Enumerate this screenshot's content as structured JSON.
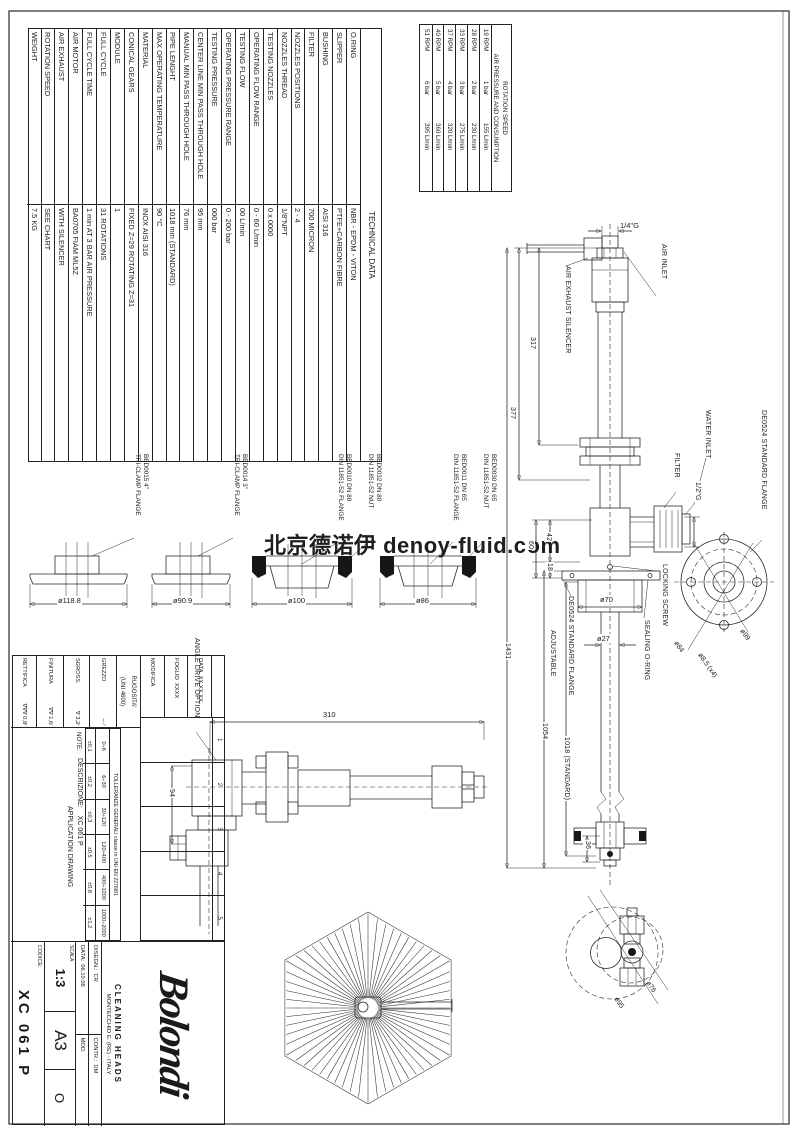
{
  "watermark": "北京德诺伊 denoy-fluid.com",
  "tech_table": {
    "header": "TECHNICAL DATA",
    "rows": [
      {
        "label": "O.RING",
        "value": "NBR - EPDM - VITON"
      },
      {
        "label": "SLIPPER",
        "value": "PTFE+CARBON FIBRE"
      },
      {
        "label": "BUSHING",
        "value": "AISI 316"
      },
      {
        "label": "FILTER",
        "value": "700 MICRON"
      },
      {
        "label": "NOZZLES POSITIONS",
        "value": "2 - 4"
      },
      {
        "label": "NOZZLES THREAD",
        "value": "1/8\"NPT"
      },
      {
        "label": "TESTING NOZZLES",
        "value": "0 x 0000"
      },
      {
        "label": "OPERATING FLOW RANGE",
        "value": "0 - 60 L/min"
      },
      {
        "label": "TESTING FLOW",
        "value": "00 L/min"
      },
      {
        "label": "OPERATING PRESSURE RANGE",
        "value": "0 - 200 bar"
      },
      {
        "label": "TESTING PRESSURE",
        "value": "000 bar"
      },
      {
        "label": "CENTER LINE MIN PASS THROUGH HOLE",
        "value": "95 mm"
      },
      {
        "label": "MANUAL MIN PASS THROUGH HOLE",
        "value": "76 mm"
      },
      {
        "label": "PIPE LENGHT",
        "value": "1018 mm (STANDARD)"
      },
      {
        "label": "MAX OPERATING TEMPERATURE",
        "value": "90 °C"
      },
      {
        "label": "MATERIAL",
        "value": "INOX AISI 316"
      },
      {
        "label": "CONICAL GEARS",
        "value": "FIXED Z=29 ROTATING Z=31"
      },
      {
        "label": "MODULE",
        "value": "1"
      },
      {
        "label": "FULL CYCLE",
        "value": "31 ROTATIONS"
      },
      {
        "label": "FULL CYCLE TIME",
        "value": "1 min AT 3 BAR AIR PRESSURE"
      },
      {
        "label": "AIR MOTOR",
        "value": "BA0705 FIAM ML5Z"
      },
      {
        "label": "AIR EXHAUST",
        "value": "WITH SILENCER"
      },
      {
        "label": "ROTATION SPEED",
        "value": "SEE CHART"
      },
      {
        "label": "WEIGHT",
        "value": "7.5 KG"
      }
    ]
  },
  "speed_table": {
    "title1": "ROTATION SPEED",
    "title2": "AIR PRESSURE AND CONSUMPTION",
    "rows": [
      {
        "rpm": "19 RPM",
        "bar": "1 bar",
        "flow": "155 L/min"
      },
      {
        "rpm": "28 RPM",
        "bar": "2 bar",
        "flow": "230 L/min"
      },
      {
        "rpm": "33 RPM",
        "bar": "3 bar",
        "flow": "275 L/min"
      },
      {
        "rpm": "37 RPM",
        "bar": "4 bar",
        "flow": "320 L/min"
      },
      {
        "rpm": "40 RPM",
        "bar": "5 bar",
        "flow": "360 L/min"
      },
      {
        "rpm": "51 RPM",
        "bar": "6 bar",
        "flow": "395 L/min"
      }
    ]
  },
  "labels": {
    "air_inlet": "AIR INLET",
    "air_inlet_size": "1/4\"G",
    "air_exhaust": "AIR EXHAUST SILENCER",
    "water_inlet": "WATER INLET",
    "water_inlet_size": "1/2\"G",
    "filter": "FILTER",
    "std_flange_right": "DE0524 STANDARD FLANGE",
    "std_flange_left": "DE0524 STANDARD FLANGE",
    "adjustable": "ADJUSTABLE",
    "locking_screw": "LOCKING SCREW",
    "sealing_oring": "SEALING O-RING",
    "angle_drive": "ANGLE DRIVE OPTION"
  },
  "dims": {
    "d317": "317",
    "d377": "377",
    "d42": "42",
    "d60": "60",
    "d18": "18",
    "d70": "ø70",
    "d27": "ø27",
    "d1431": "1431",
    "d1054": "1054",
    "d1018": "1018 (STANDARD)",
    "d36": "36",
    "d310": "310",
    "d94": "94",
    "d84": "ø84",
    "d85": "ø8.5 (x4)",
    "d99": "ø99",
    "d76": "ø76",
    "d95": "ø95"
  },
  "flange_dims": {
    "d1188": "ø118.8",
    "d909": "ø90.9",
    "d100": "ø100",
    "d86": "ø86"
  },
  "flanges": [
    {
      "code": "BED0015 4\"",
      "type": "TRI-CLAMP FLANGE"
    },
    {
      "code": "BED0014 3\"",
      "type": "TRI-CLAMP FLANGE"
    },
    {
      "code": "BED0010 DN 80",
      "type": "DIN 11851-52 FLANGE"
    },
    {
      "code": "BED0032 DN 80",
      "type": "DIN 11851-52 NUT"
    },
    {
      "code": "BED0011 DN 65",
      "type": "DIN 11851-52 FLANGE"
    },
    {
      "code": "BED0030 DN 65",
      "type": "DIN 11851-52 NUT"
    }
  ],
  "title_block": {
    "modifica": "MODIFICA",
    "foglio": "FOGLIO",
    "foglio_v": "XXXX",
    "data": "DATA",
    "data_v": "XX.XX.XX",
    "revisions": [
      "1",
      "2",
      "3",
      "4",
      "5"
    ],
    "tol_header": "TOLLERANZE GENERALI classe m UNI-EN 22768/1",
    "tol_ranges": [
      "0÷6",
      "6÷30",
      "30÷120",
      "120÷400",
      "400÷1000",
      "1000÷2000"
    ],
    "tol_values": [
      "±0,1",
      "±0,2",
      "±0,3",
      "±0,5",
      "±0,8",
      "±1,2"
    ],
    "note": "NOTE:",
    "descr_label": "DESCRIZIONE:",
    "descr_value": "XC 061 P",
    "descr_line2": "APPLICATION DRAWING",
    "rug_header1": "RUGOSITA'",
    "rug_header2": "(UNI 4600)",
    "rug_rows": [
      {
        "label": "GREZZO",
        "value": "∼ ∕"
      },
      {
        "label": "SGROSS.",
        "value": "∇ 3,2∕"
      },
      {
        "label": "FINITURA",
        "value": "∇∇ 1,6∕"
      },
      {
        "label": "RETTIFICA",
        "value": "∇∇∇ 0,8∕"
      }
    ],
    "logo": "Bolondi",
    "brand1": "CLEANING HEADS",
    "brand2": "MONTECCHIO E. (RE) - ITALY",
    "disegn_l": "DISEGN.:",
    "disegn_v": "CR",
    "contr_l": "CONTR.:",
    "contr_v": "DM",
    "data_l": "DATA:",
    "data_v2": "06.10.08",
    "mod_l": "MOD.",
    "scala_l": "SCALA",
    "scala_v": "1:3",
    "format": "A3",
    "proj": "O",
    "codice_l": "CODICE:",
    "codice_v": "XC 061 P"
  }
}
